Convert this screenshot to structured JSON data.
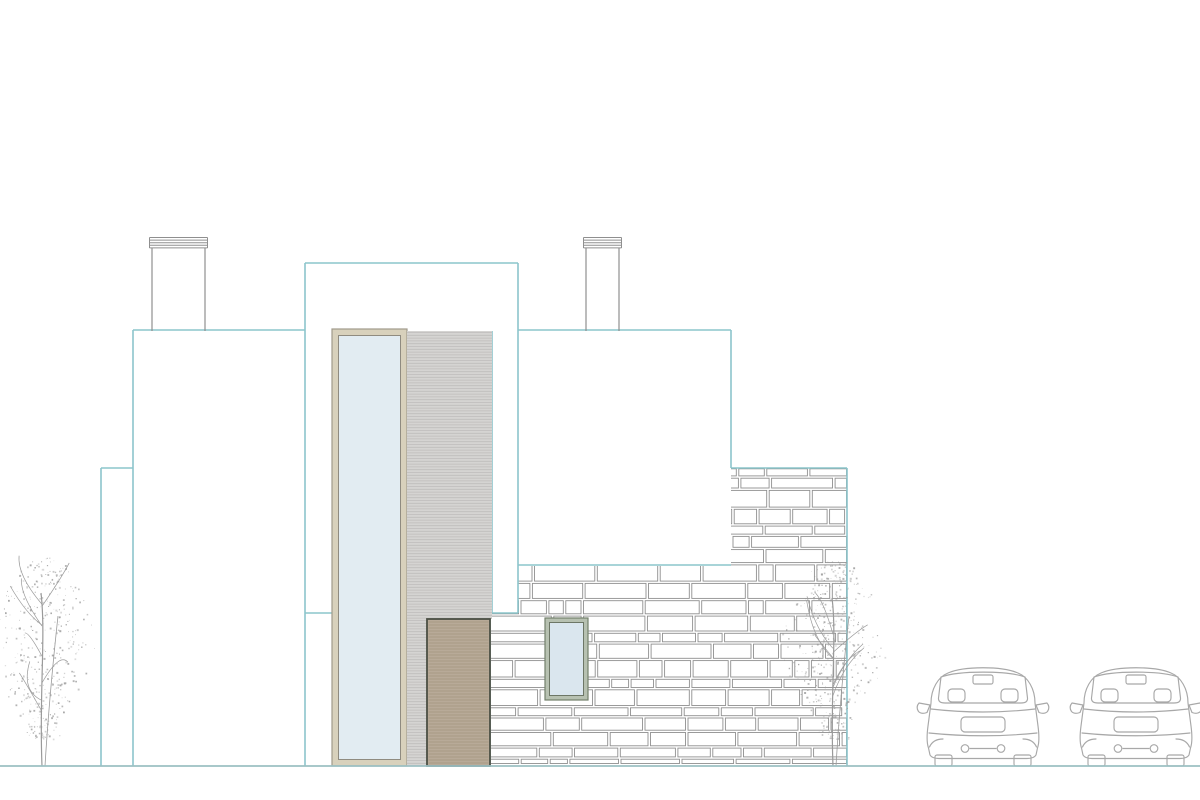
{
  "scene": {
    "kind": "architectural-elevation-drawing",
    "elements": [
      "chimney-left",
      "chimney-right",
      "wall-block-left-small",
      "wall-block-left",
      "wall-block-center-tall",
      "wall-block-right",
      "tall-window",
      "slat-panel",
      "entry-door",
      "stone-wall",
      "stone-wall-window",
      "tree-left",
      "tree-right",
      "car-left",
      "car-right",
      "ground-line"
    ]
  },
  "colors": {
    "background": "#ffffff",
    "outline_teal": "#8cc5cb",
    "ground_line": "#9cc0c3",
    "drawing_gray": "#8f8f8f",
    "stone_line_gray": "#8f8f8f",
    "car_gray": "#a8a8a8",
    "tree_gray": "#9a9a9a",
    "window_frame_tan": "#d8d1bc",
    "window_frame_edge": "#a09a8b",
    "window_glass": "#e2ecf2",
    "slat_panel_gray": "#d5d4d2",
    "slat_line_gray": "#bebdbb",
    "door_tan": "#b8aa98",
    "door_line": "#a4967f",
    "door_outline": "#4b4f44",
    "stone_window_frame": "#b7c1b1",
    "stone_window_edge": "#73806c",
    "stone_window_glass": "#dae6ee"
  }
}
